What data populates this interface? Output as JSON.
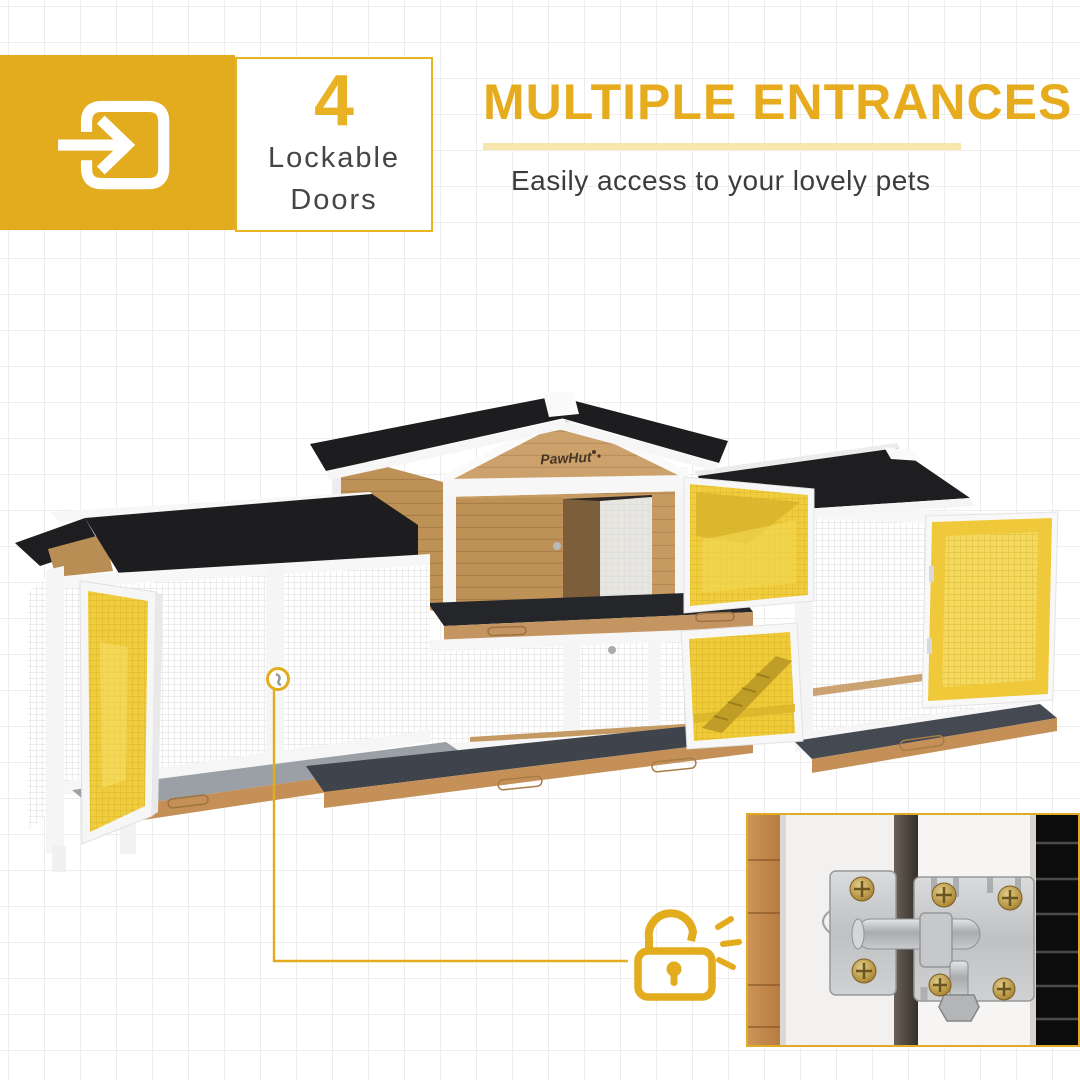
{
  "page": {
    "bg_color": "#ffffff",
    "grid_color": "#efedec"
  },
  "badge": {
    "count": "4",
    "label_line1": "Lockable",
    "label_line2": "Doors",
    "accent_color": "#E3AC1E",
    "icon": "enter-arrow-icon"
  },
  "header": {
    "title": "MULTIPLE ENTRANCES",
    "subtitle": "Easily access to your lovely pets",
    "title_color": "#E6AC1E",
    "underline_color": "#F7E7AC",
    "subtitle_color": "#3C3C3C"
  },
  "product": {
    "brand_logo": "PawHut",
    "highlight_color": "#F0CD3C",
    "roof_color": "#1D1D1F",
    "wood_color": "#C79A62",
    "frame_color": "#FFFFFF",
    "mesh_color": "#D9D9D9"
  },
  "callout": {
    "icon": "open-padlock-icon",
    "line_color": "#E3AC1E"
  },
  "inset": {
    "icon": "slide-bolt-latch-photo",
    "border_color": "#E0AC25"
  }
}
